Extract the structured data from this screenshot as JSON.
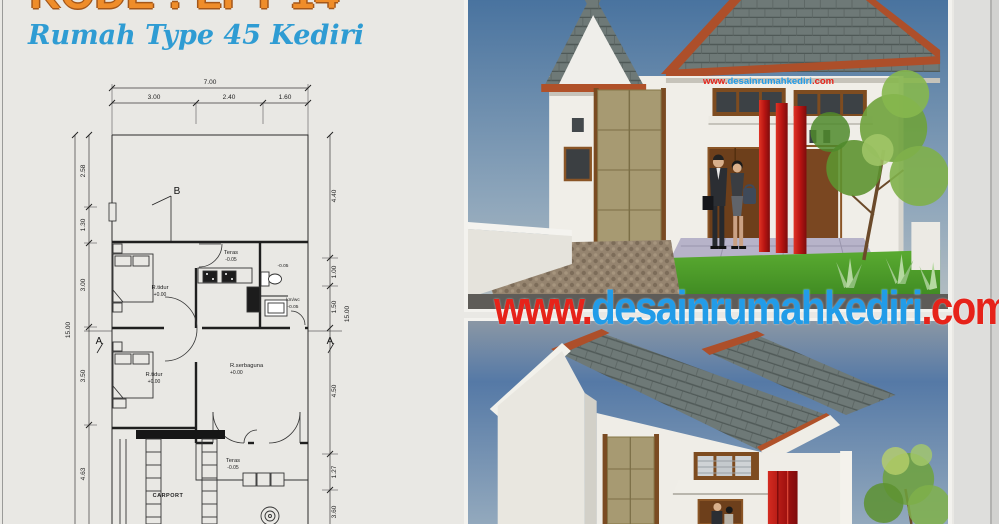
{
  "header": {
    "code_title": "KODE : LPT 14",
    "subtitle": "Rumah Type 45 Kediri"
  },
  "floor_plan": {
    "dims_top": {
      "total": "7.00",
      "segments": [
        "3.00",
        "2.40",
        "1.60"
      ]
    },
    "dims_left": {
      "total": "15.00",
      "segments": [
        "2.58",
        "1.30",
        "3.00",
        "3.50",
        "4.63"
      ]
    },
    "dims_right": {
      "total": "15.00",
      "segments": [
        "4.40",
        "1.00",
        "1.50",
        "4.50",
        "1.27",
        "3.60"
      ]
    },
    "rooms": {
      "bedroom1": {
        "label": "R.tidur",
        "elev": "+0.00"
      },
      "back_terrace": {
        "label": "Teras",
        "elev": "-0.05"
      },
      "bathroom": {
        "label": "km/wc",
        "elev": "-0.05"
      },
      "bathroom_upper_elev": "-0.05",
      "bedroom2": {
        "label": "R.tidur",
        "elev": "+0.00"
      },
      "multipurpose": {
        "label": "R.serbaguna",
        "elev": "+0.00"
      },
      "front_terrace": {
        "label": "Teras",
        "elev": "-0.05"
      },
      "carport": {
        "label": "CARPORT"
      }
    },
    "section_markers": {
      "a": "A",
      "b": "B"
    }
  },
  "watermark": {
    "prefix": "www.",
    "domain": "desainrumahkediri",
    "tld": ".com",
    "red": "#e6231a",
    "blue": "#229ce8"
  },
  "colors": {
    "sheet_bg": "#e9e8e4",
    "roof_tile": "#6e7977",
    "roof_trim_terracotta": "#ad4f2a",
    "accent_red_pillar": "#b81512",
    "wall_white": "#f0eee8",
    "panel_beige": "#a79a72",
    "door_brown": "#6d3f1b",
    "grass_green": "#4f9e2c",
    "sky_blue": "#4a74a4",
    "title_orange": "#ef8d2a",
    "subtitle_blue": "#2f9cd3"
  }
}
